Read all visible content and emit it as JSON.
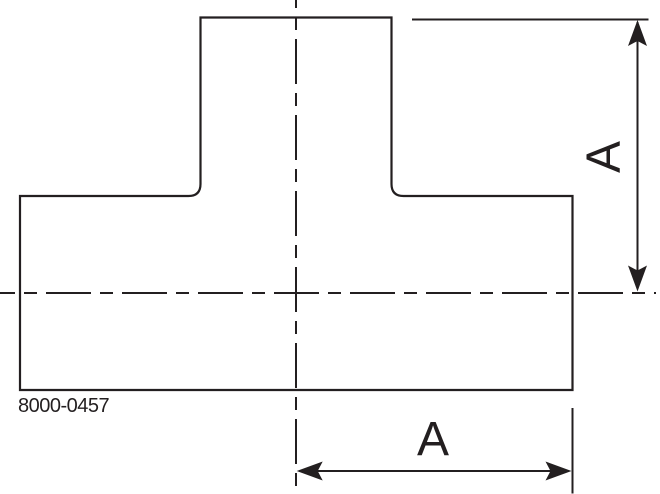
{
  "drawing": {
    "type": "technical-drawing-tee-fitting",
    "part_number": "8000-0457",
    "dimension_labels": {
      "vertical": "A",
      "horizontal": "A"
    },
    "colors": {
      "line": "#231f20",
      "background": "#ffffff"
    }
  }
}
